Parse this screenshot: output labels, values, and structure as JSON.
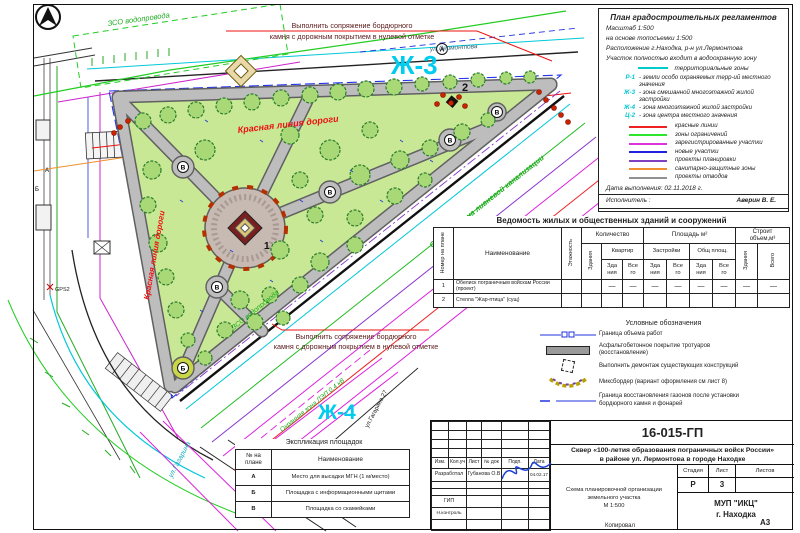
{
  "map": {
    "zh3": "Ж-3",
    "zh4": "Ж-4",
    "street_top": "ул.Лермонтова",
    "street_bottom": "ул.Гагарина",
    "building_address": "ул.Гагарина 27",
    "red_line_top": "Красная линия дороги",
    "red_line_left": "Красная линия дороги",
    "zso_top": "ЗСО водопровода",
    "zso_inner": "ЗСО водопровода",
    "storm_zone": "Охранная зона ливневой канализации",
    "power_zone": "Охранная зона ЛЭП 0,4 кВ",
    "gps": "GPS2",
    "annotation_line1": "Выполнить сопряжение бордюрного",
    "annotation_line2": "камня с дорожным покрытием в нулевой отметке",
    "marker_1": "1",
    "marker_2": "2",
    "marker_a": "А",
    "marker_b": "Б",
    "marker_v": "В"
  },
  "regulations": {
    "title": "План градостроительных регламентов",
    "line1": "Масштаб 1:500",
    "line2": "на основе топосъемки 1:500",
    "line3": "Расположение г.Находка, р-н ул.Лермонтова",
    "line4": "Участок полностью входит в водоохранную зону",
    "zones_title": "территориальные зоны",
    "zones": [
      {
        "code": "Р-1",
        "desc": "земли особо охраняемых терр-ий местного значения"
      },
      {
        "code": "Ж-3",
        "desc": "зона смешанной многоэтажной жилой застройки"
      },
      {
        "code": "Ж-4",
        "desc": "зона многоэтажной жилой застройки"
      },
      {
        "code": "Ц-2",
        "desc": "зона центра местного значения"
      }
    ],
    "legend": [
      {
        "label": "красные линии",
        "color": "#ee2222"
      },
      {
        "label": "зоны ограничений",
        "color": "#2ee62e"
      },
      {
        "label": "зарегистрированные участки",
        "color": "#dd33dd"
      },
      {
        "label": "новые участки",
        "color": "#2222dd"
      },
      {
        "label": "проекты планировки",
        "color": "#8040c0"
      },
      {
        "label": "санитарно-защитные зоны",
        "color": "#f09030"
      },
      {
        "label": "проекты отводов",
        "color": "#909090"
      }
    ],
    "date_line": "Дата выполнения: 02.11.2018 г.",
    "executor_label": "Исполнитель :",
    "executor_name": "Аверин В. Е.",
    "checked_label": "Проверено :",
    "checked_name": "Мосевицкий А. А."
  },
  "buildings_table": {
    "title": "Ведомость жилых и общественных зданий и сооружений",
    "h_num": "Номер на плане",
    "h_name": "Наименование",
    "h_floors": "Этажность",
    "h_qty": "Количество",
    "h_area": "Площадь м²",
    "h_vol": "Строит\nобъем,м³",
    "h_bld": "Здания",
    "h_apt": "Квартир",
    "h_dev": "Застройки",
    "h_common": "Общ площ.",
    "h_total": "Всего",
    "h_b2": "Зда\nния",
    "h_v2": "Все\nго",
    "rows": [
      {
        "num": "1",
        "name": "Обелиск пограничным войскам России (проект)",
        "v": [
          "",
          "",
          "—",
          "—",
          "—",
          "—",
          "—",
          "—",
          "—",
          "—"
        ]
      },
      {
        "num": "2",
        "name": "Стелла \"Жар-птица\" (сущ)",
        "v": [
          "",
          "",
          "",
          "",
          "",
          "",
          "",
          "",
          "",
          ""
        ]
      }
    ]
  },
  "symbols": {
    "title": "Условные обозначения",
    "items": [
      "Граница объема работ",
      "Асфальтобетонное покрытие тротуаров\n(восстановление)",
      "Выполнить демонтаж существующих конструкций",
      "Миксбордер (вариант оформления см лист 8)",
      "Граница восстановления газонов после установки\nбордюрного камня и фонарей"
    ]
  },
  "explication": {
    "title": "Экспликация площадок",
    "h_num": "№ на\nплане",
    "h_name": "Наименование",
    "rows": [
      {
        "num": "А",
        "name": "Место для высадки  МГН (1 м/место)"
      },
      {
        "num": "Б",
        "name": "Площадка с информационными щитами"
      },
      {
        "num": "В",
        "name": "Площадка со скамейками"
      }
    ]
  },
  "title_block": {
    "doc_number": "16-015-ГП",
    "project_title": "Сквер «100-летия образования пограничных войск России»\nв районе ул. Лермонтова в городе Находке",
    "c_izm": "Изм.",
    "c_koluch": "Кол.уч",
    "c_list": "Лист",
    "c_ndok": "№ док",
    "c_podp": "Подп.",
    "c_data": "Дата",
    "developed_label": "Разработал",
    "developed_name": "Губанова О.В",
    "date_value": "04.02.17",
    "gip": "ГИП",
    "ncontrol": "Н.контроль",
    "stage_label": "Стадия",
    "sheet_label": "Лист",
    "sheets_label": "Листов",
    "stage_value": "Р",
    "sheet_value": "3",
    "scheme_text": "Схема планировочной организации\nземельного участка\nМ 1:500",
    "org": "МУП \"ИКЦ\"\nг. Находка",
    "copied": "Копировал",
    "format": "А3"
  }
}
